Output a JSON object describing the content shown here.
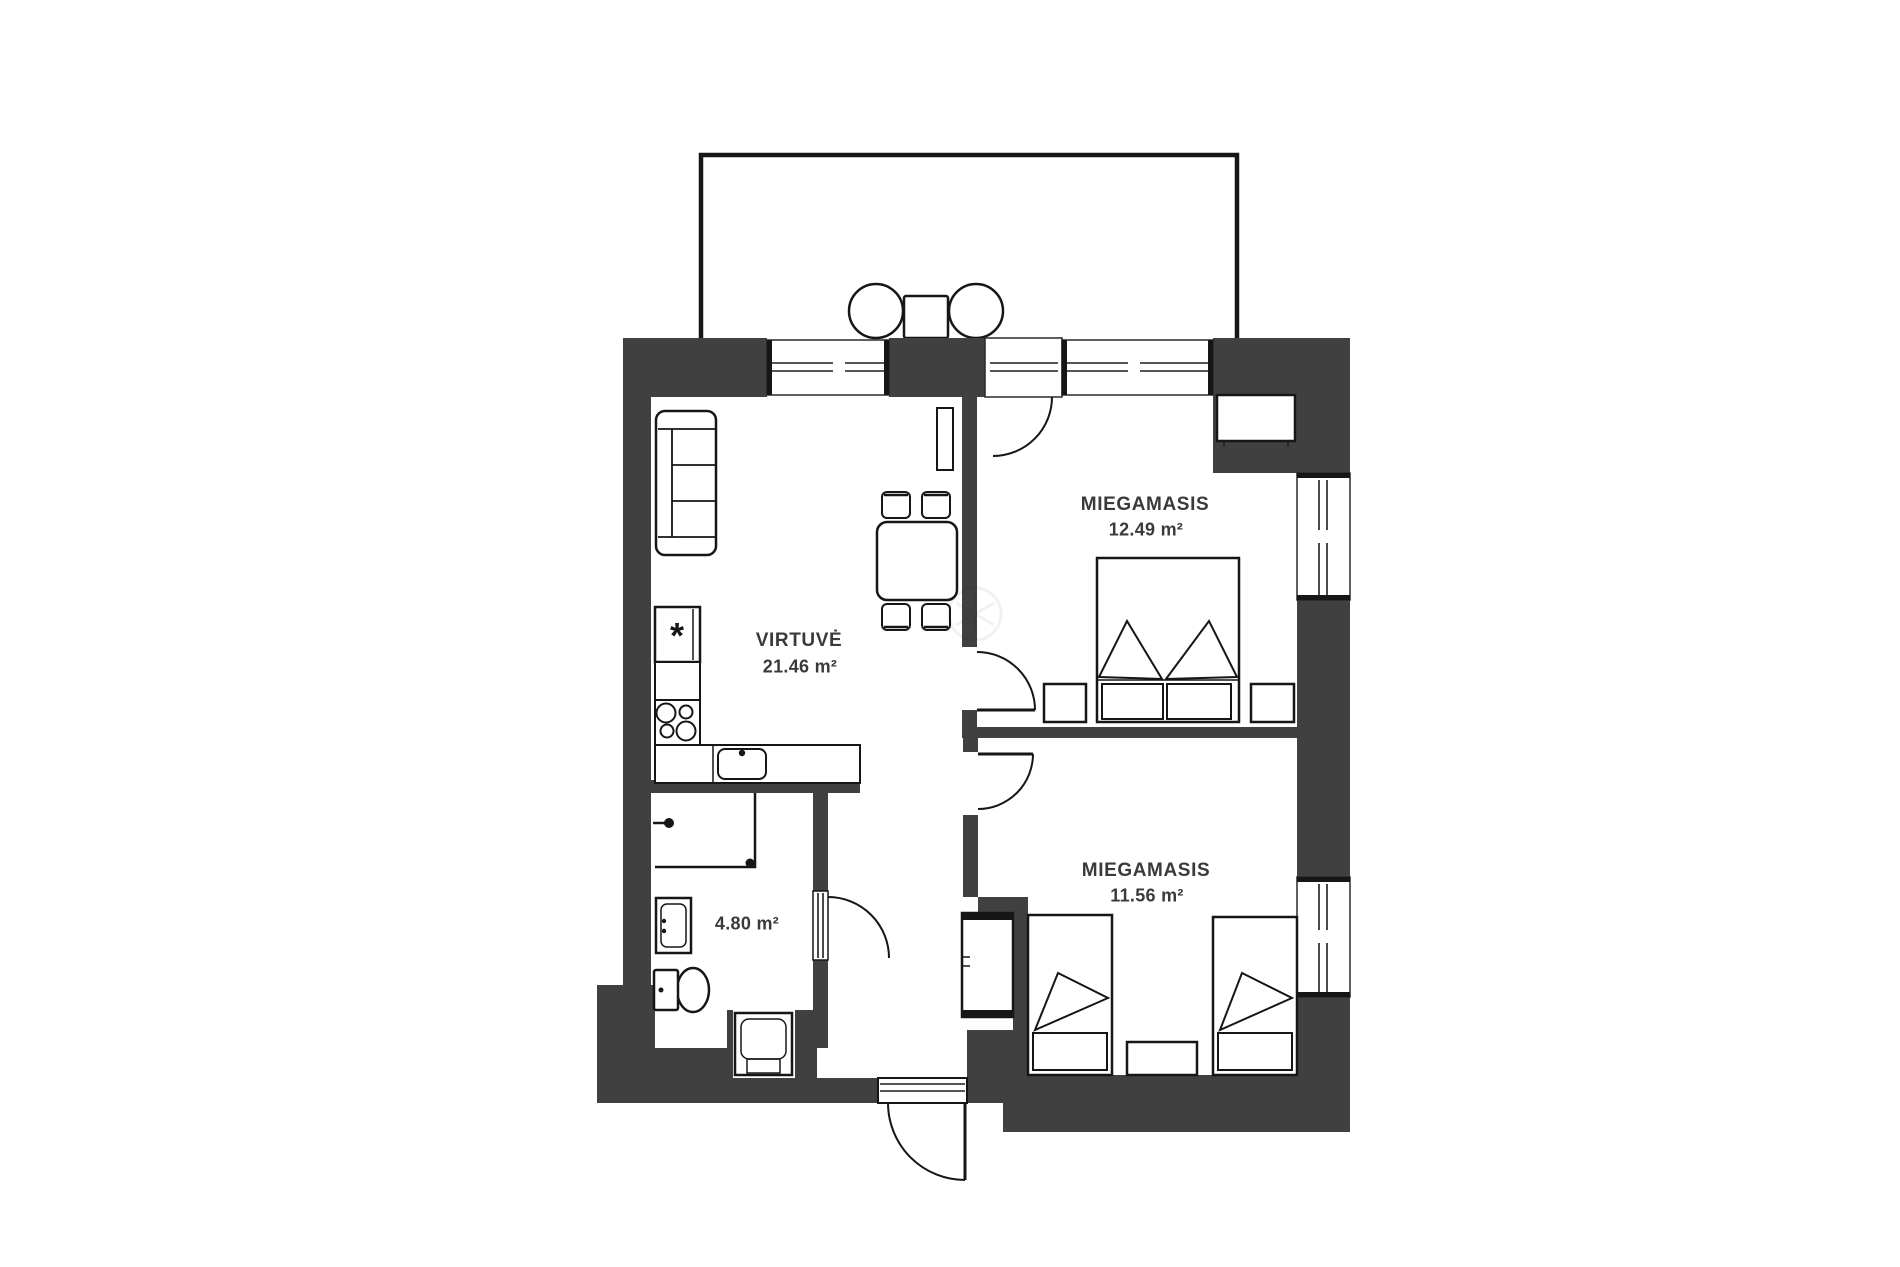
{
  "rooms": {
    "kitchen": {
      "name": "VIRTUVĖ",
      "area": "21.46 m²"
    },
    "bedroom_top": {
      "name": "MIEGAMASIS",
      "area": "12.49 m²"
    },
    "bedroom_bottom": {
      "name": "MIEGAMASIS",
      "area": "11.56 m²"
    },
    "bathroom": {
      "area": "4.80 m²"
    }
  },
  "symbols": {
    "boiler": "*"
  },
  "colors": {
    "wall": "#404040",
    "line": "#161616",
    "label": "#3a3a3a",
    "background": "#ffffff"
  }
}
